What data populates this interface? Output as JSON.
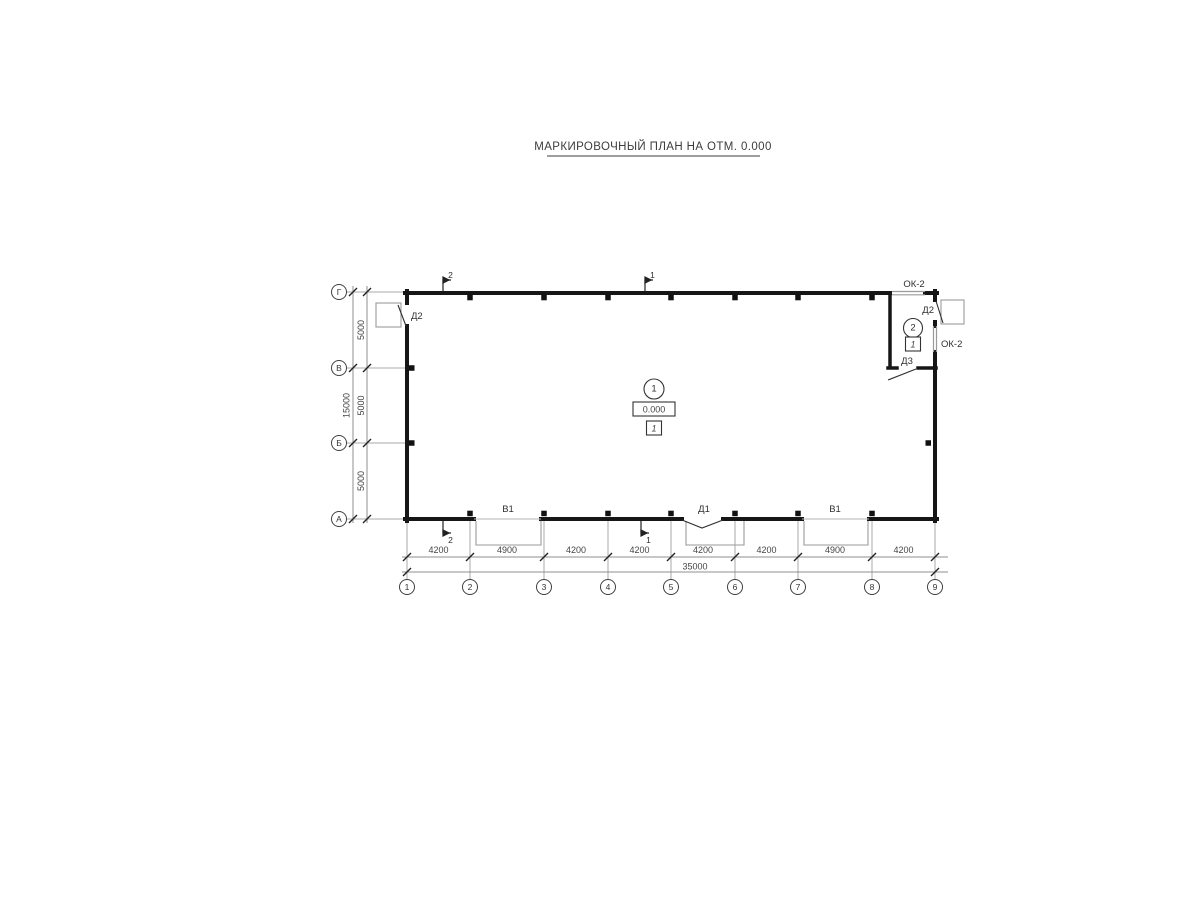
{
  "title": "МАРКИРОВОЧНЫЙ ПЛАН НА ОТМ. 0.000",
  "axes": {
    "columns": [
      "1",
      "2",
      "3",
      "4",
      "5",
      "6",
      "7",
      "8",
      "9"
    ],
    "rows": [
      "Г",
      "В",
      "Б",
      "А"
    ]
  },
  "dims": {
    "bottom": [
      "4200",
      "4900",
      "4200",
      "4200",
      "4200",
      "4200",
      "4900",
      "4200"
    ],
    "bottom_total": "35000",
    "left": [
      "5000",
      "5000",
      "5000"
    ],
    "left_total": "15000"
  },
  "marks": {
    "doors": {
      "d1": "Д1",
      "d2_left": "Д2",
      "d2_right": "Д2",
      "d3": "Д3"
    },
    "gates": {
      "v1_left": "В1",
      "v1_right": "В1"
    },
    "windows": {
      "ok2_top": "ОК-2",
      "ok2_right": "ОК-2"
    }
  },
  "rooms": {
    "room1": {
      "number": "1",
      "elevation": "0.000",
      "floor_type": "1"
    },
    "room2": {
      "number": "2",
      "floor_type": "1"
    }
  },
  "sections": {
    "s1": "1",
    "s2": "2"
  }
}
